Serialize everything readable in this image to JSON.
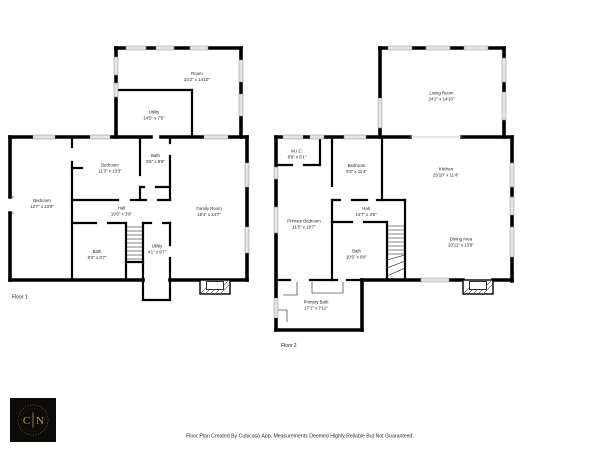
{
  "colors": {
    "wall": "#000000",
    "window_fill": "#e4e4e4",
    "text": "#1b1b1b",
    "logo_background": "#0c0b09",
    "logo_gold": "#c09655"
  },
  "branding": {
    "footer_text": "Floor Plan Created By Cubicasa App. Measurements Deemed Highly Reliable But Not Guaranteed.",
    "logo": {
      "letter_left": "C",
      "letter_right": "N"
    }
  },
  "floor1": {
    "label": "Floor 1",
    "rooms": [
      {
        "name": "Room",
        "dims": "24'2\" x 14'10\""
      },
      {
        "name": "Utility",
        "dims": "14'5\" x 7'5\""
      },
      {
        "name": "Bedroom",
        "dims": "11'3\" x 13'3\""
      },
      {
        "name": "Bath",
        "dims": "5'5\" x 9'8\""
      },
      {
        "name": "Bedroom",
        "dims": "12'7\" x 23'0\""
      },
      {
        "name": "Hall",
        "dims": "19'6\" x 3'6\""
      },
      {
        "name": "Family Room",
        "dims": "15'4\" x 24'7\""
      },
      {
        "name": "Bath",
        "dims": "9'3\" x 9'7\""
      },
      {
        "name": "Utility",
        "dims": "4'1\" x 9'7\""
      }
    ]
  },
  "floor2": {
    "label": "Floor 2",
    "rooms": [
      {
        "name": "Living Room",
        "dims": "24'2\" x 14'10\""
      },
      {
        "name": "W.I.C.",
        "dims": "8'8\" x 5'1\""
      },
      {
        "name": "Bedroom",
        "dims": "9'3\" x 11'4\""
      },
      {
        "name": "Kitchen",
        "dims": "25'10\" x 11'4\""
      },
      {
        "name": "Primary Bedroom",
        "dims": "11'5\" x 19'7\""
      },
      {
        "name": "Hall",
        "dims": "14'7\" x 3'6\""
      },
      {
        "name": "Bath",
        "dims": "10'5\" x 9'8\""
      },
      {
        "name": "Dining Area",
        "dims": "20'11\" x 13'9\""
      },
      {
        "name": "Primary Bath",
        "dims": "17'1\" x 7'11\""
      }
    ]
  }
}
